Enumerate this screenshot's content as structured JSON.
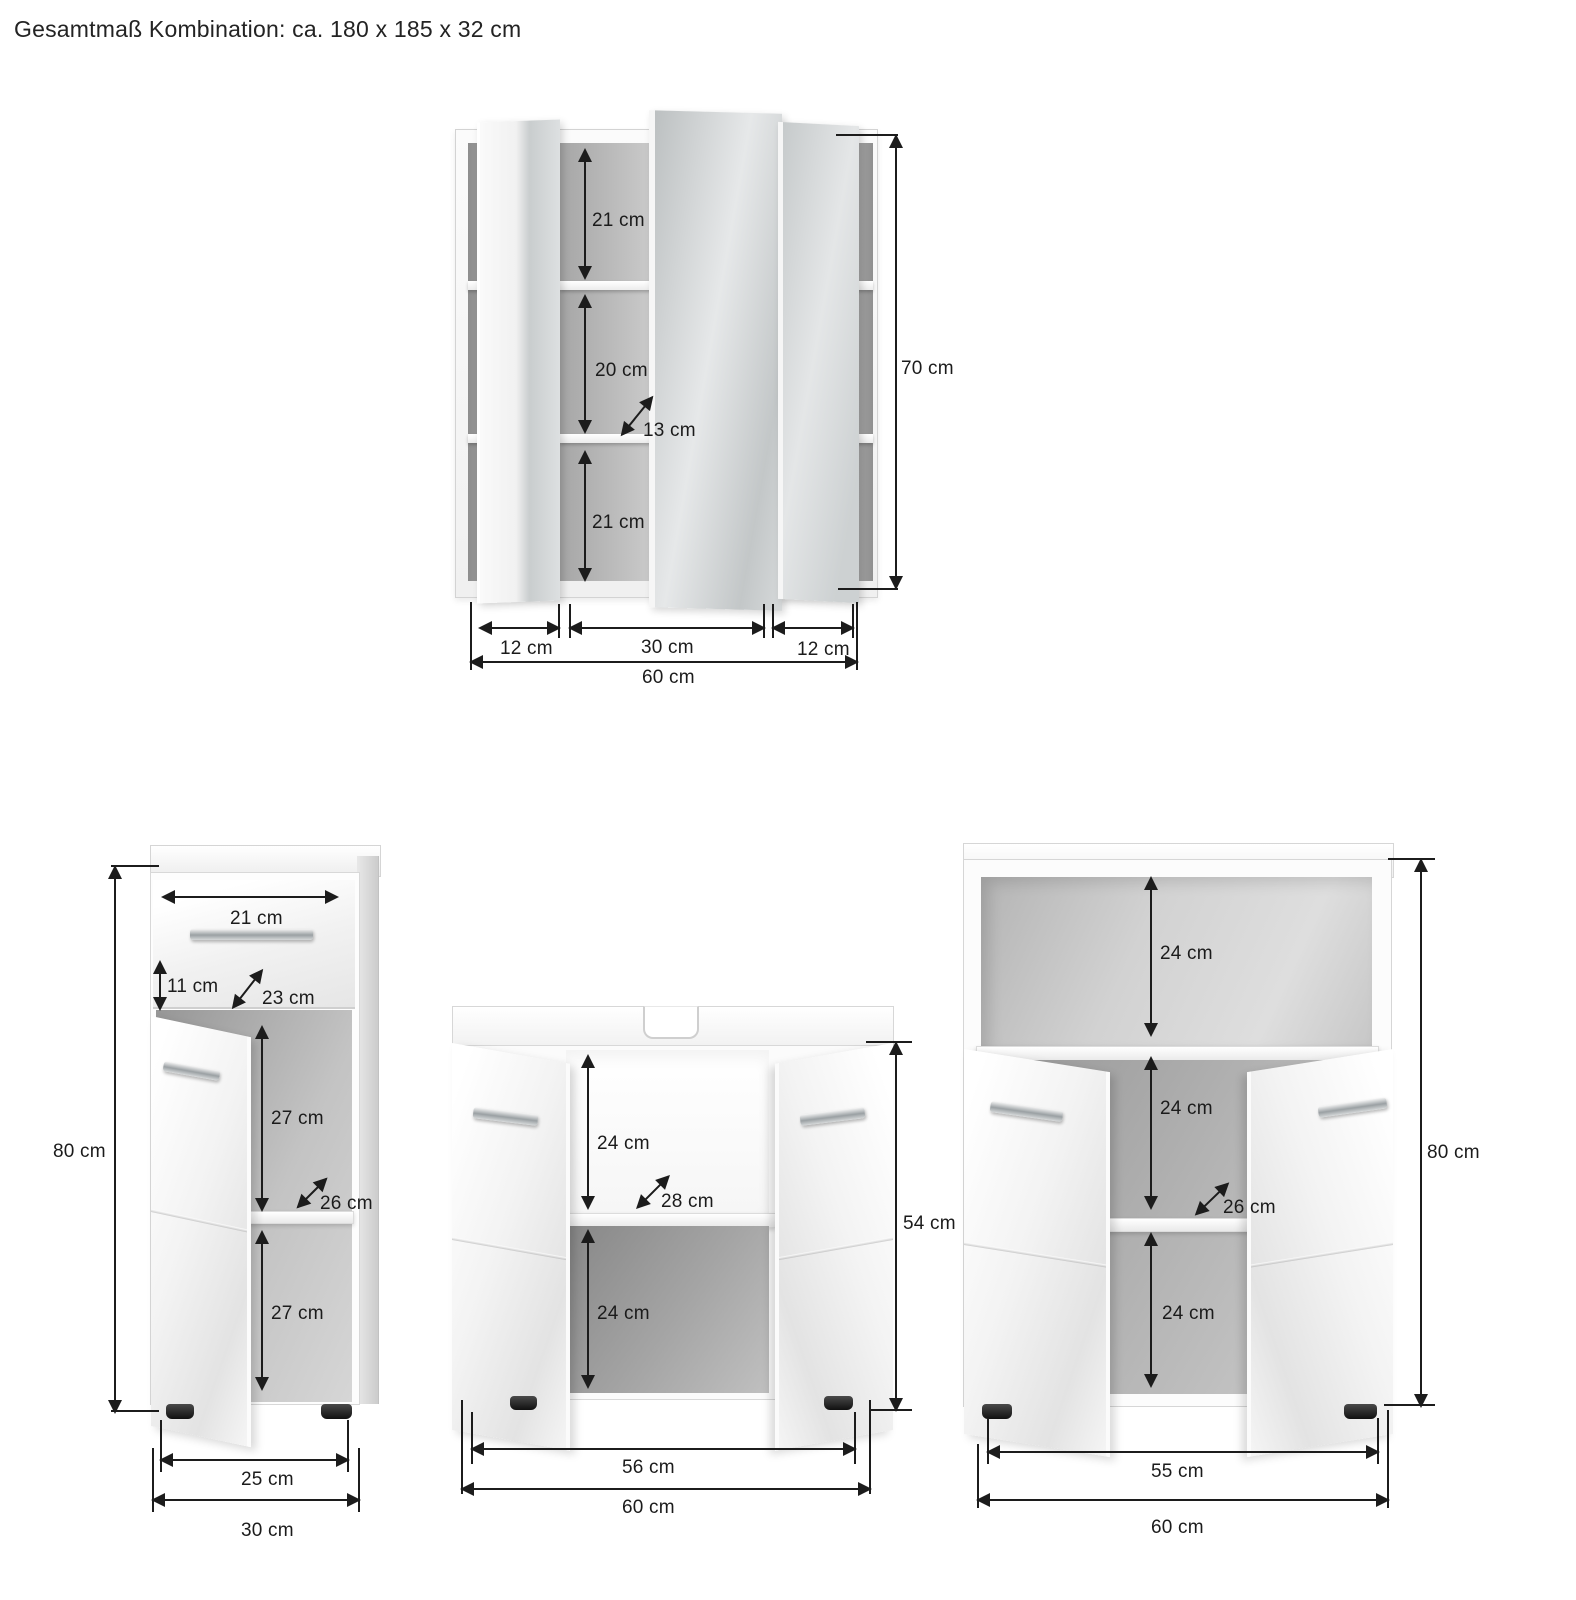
{
  "title": "Gesamtmaß Kombination: ca. 180 x 185 x 32 cm",
  "style": {
    "ink": "#1c1c1c"
  },
  "mirror_cabinet": {
    "shelf_top": "21 cm",
    "shelf_middle": "20 cm",
    "depth": "13 cm",
    "shelf_bottom": "21 cm",
    "height": "70 cm",
    "door_left_width": "12 cm",
    "center_width": "30 cm",
    "door_right_width": "12 cm",
    "total_width": "60 cm"
  },
  "side_cabinet": {
    "drawer_width": "21 cm",
    "drawer_front_height": "11 cm",
    "drawer_depth": "23 cm",
    "compartment_top": "27 cm",
    "depth": "26 cm",
    "compartment_bottom": "27 cm",
    "height": "80 cm",
    "inner_width": "25 cm",
    "total_width": "30 cm"
  },
  "washbasin_cabinet": {
    "compartment_top": "24 cm",
    "depth": "28 cm",
    "compartment_bottom": "24 cm",
    "height": "54 cm",
    "inner_width": "56 cm",
    "total_width": "60 cm"
  },
  "floor_cabinet": {
    "shelf_height": "24 cm",
    "compartment_middle": "24 cm",
    "depth": "26 cm",
    "compartment_bottom": "24 cm",
    "height": "80 cm",
    "inner_width": "55 cm",
    "total_width": "60 cm"
  }
}
